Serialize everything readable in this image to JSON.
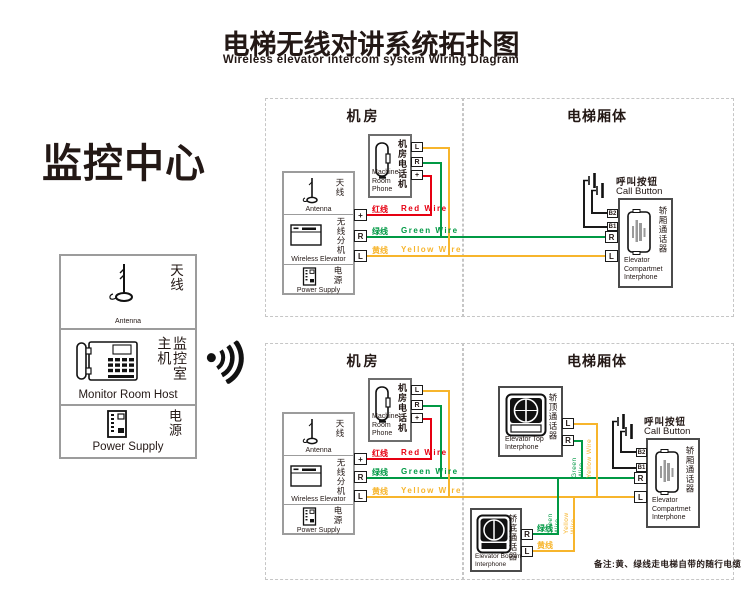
{
  "title": {
    "zh": "电梯无线对讲系统拓扑图",
    "en": "Wireless elevator intercom system Wiring Diagram"
  },
  "monitor_center": {
    "title": "监控中心",
    "antenna_zh": "天线",
    "antenna_en": "Antenna",
    "host_zh": "监控室主机",
    "host_en": "Monitor Room Host",
    "power_zh": "电源",
    "power_en": "Power Supply"
  },
  "labels": {
    "machine_room": "机房",
    "car_body": "电梯厢体",
    "phone_zh": "机房电话机",
    "phone_en": "Machine Room Phone",
    "antenna_zh": "天线",
    "antenna_en": "Antenna",
    "ext_zh": "无线分机",
    "ext_en": "Wireless Elevator",
    "power_zh": "电源",
    "power_en": "Power Supply",
    "call_zh": "呼叫按钮",
    "call_en": "Call Button",
    "compartment_zh": "轿厢通话器",
    "compartment_en": "Elevator Compartmet Interphone",
    "top_interphone_zh": "轿顶通话器",
    "top_interphone_en": "Elevator Top Interphone",
    "bottom_interphone_zh": "轿底通话器",
    "bottom_interphone_en": "Elevator Bottom Interphone"
  },
  "terminals": {
    "l": "L",
    "r": "R",
    "plus": "+",
    "b1": "B1",
    "b2": "B2"
  },
  "wires": {
    "red_zh": "红线",
    "red_en": "Red Wire",
    "green_zh": "绿线",
    "green_en": "Green Wire",
    "yellow_zh": "黄线",
    "yellow_en": "Yellow Wire",
    "green_vertical": "Green Wire",
    "yellow_vertical": "Yellow Wire"
  },
  "colors": {
    "red": "#e60012",
    "green": "#009944",
    "yellow": "#f7b52c",
    "ink": "#231815"
  },
  "note": "备注:黄、绿线走电梯自带的随行电缆"
}
